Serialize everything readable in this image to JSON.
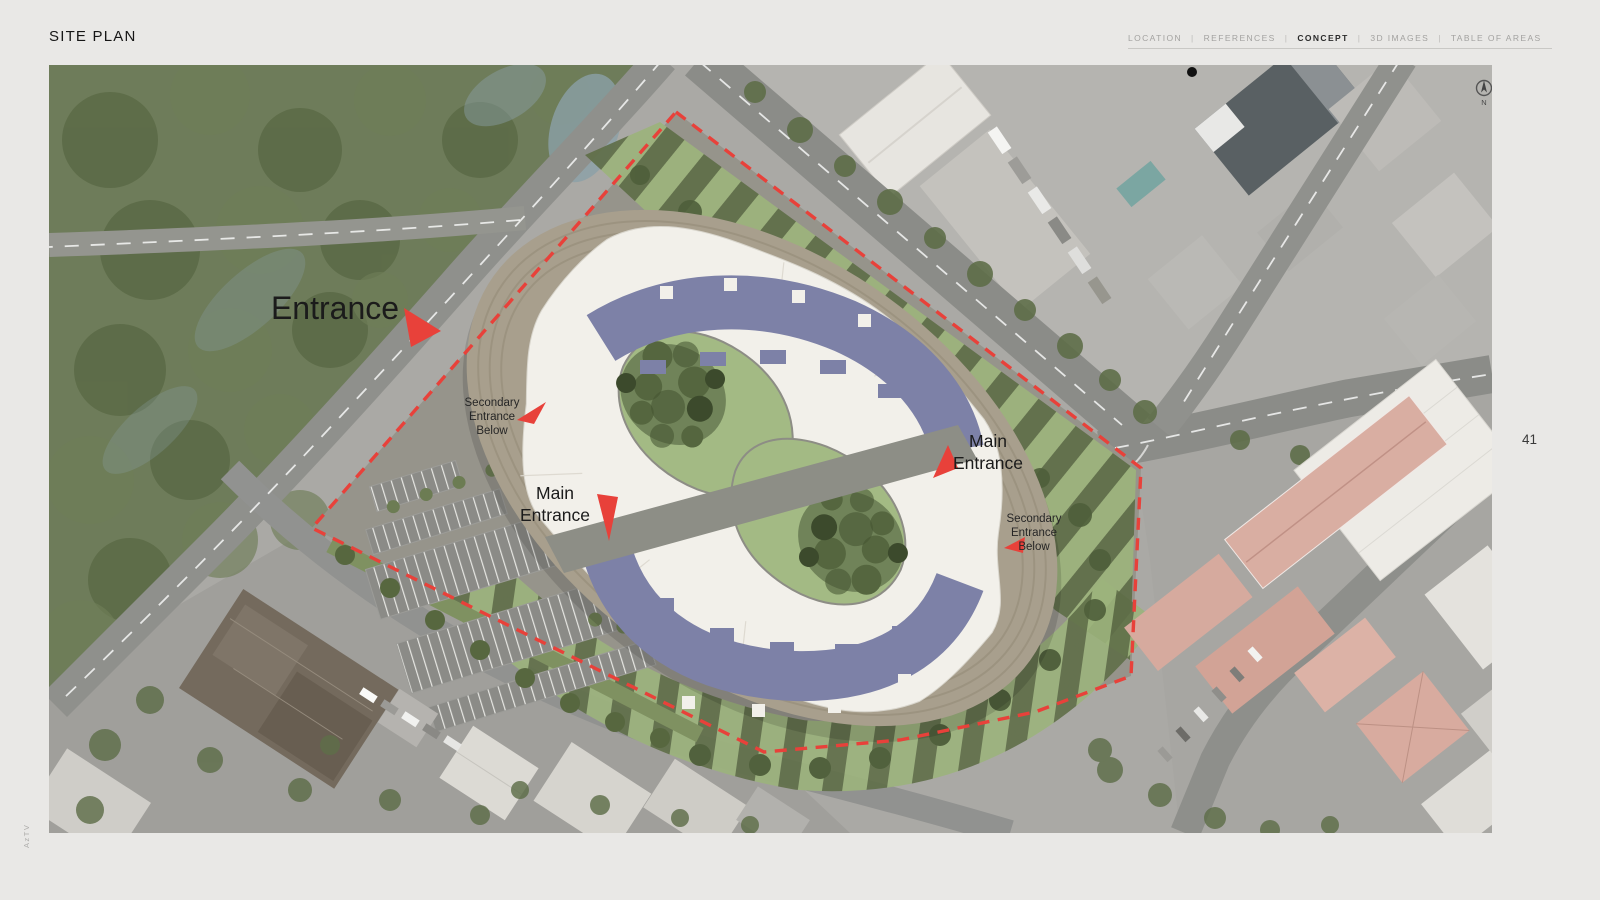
{
  "page": {
    "title": "SITE PLAN",
    "page_number": "41",
    "watermark": "AzTV"
  },
  "nav": {
    "separator": "|",
    "items": [
      {
        "label": "LOCATION",
        "active": false
      },
      {
        "label": "REFERENCES",
        "active": false
      },
      {
        "label": "CONCEPT",
        "active": true
      },
      {
        "label": "3D IMAGES",
        "active": false
      },
      {
        "label": "TABLE OF AREAS",
        "active": false
      }
    ]
  },
  "map": {
    "type": "aerial-site-plan",
    "annotations": {
      "entrance": "Entrance",
      "secondary_left": {
        "line1": "Secondary",
        "line2": "Entrance",
        "line3": "Below"
      },
      "main_left": {
        "line1": "Main",
        "line2": "Entrance"
      },
      "main_right": {
        "line1": "Main",
        "line2": "Entrance"
      },
      "secondary_right": {
        "line1": "Secondary",
        "line2": "Entrance",
        "line3": "Below"
      }
    },
    "compass": {
      "label": "N"
    },
    "colors": {
      "accent_red": "#e8413a",
      "roof_purple": "#7d81a7",
      "lawn_green": "#9cb37c",
      "tree_green": "#55663f",
      "forest_green": "#6e7c5a",
      "water_blue": "#8ba0a8",
      "building_white": "#f2f0ea",
      "terrace_beige": "#a89f8d",
      "site_gray": "#96948b",
      "road_gray": "#8b8c88",
      "pink_roof": "#d9aea2"
    }
  }
}
